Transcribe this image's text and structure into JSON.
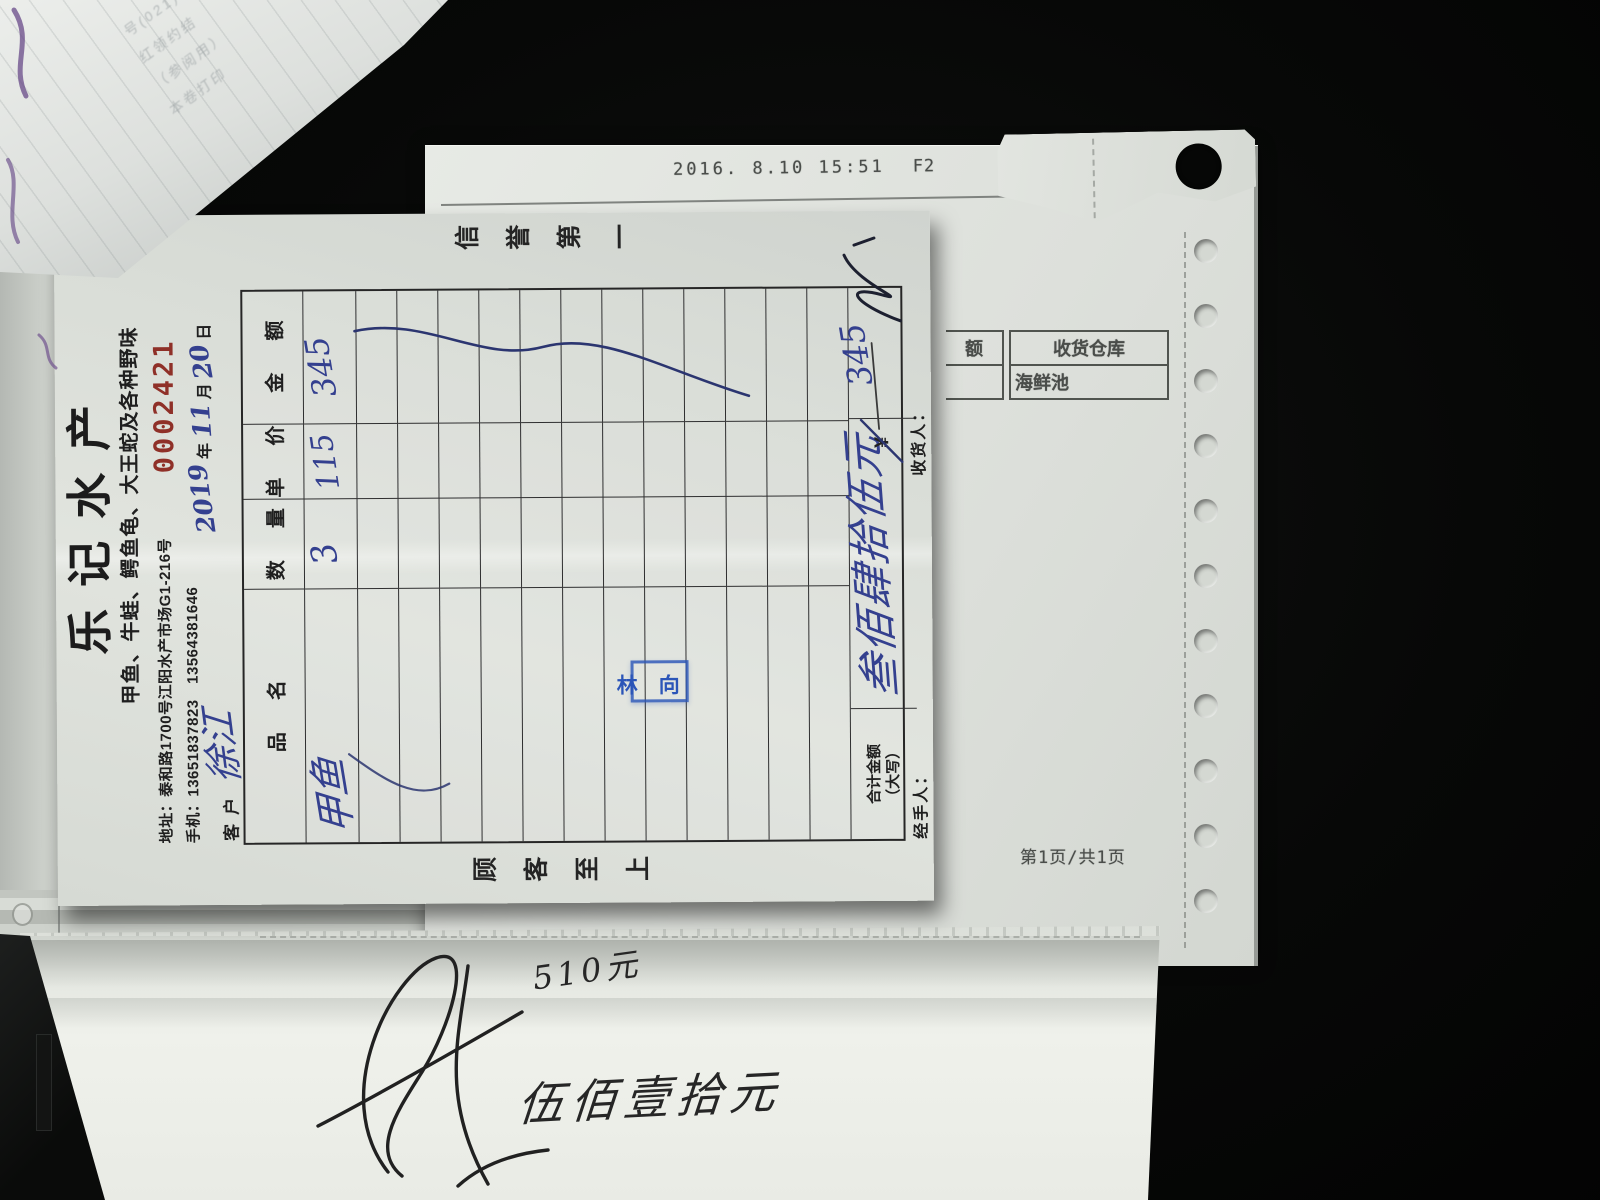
{
  "colors": {
    "ink_blue": "#34408f",
    "stamp_blue": "#2b55b8",
    "serial_red": "#8f3028",
    "paper": "#dfe2dc",
    "desk_black": "#070807"
  },
  "receipt": {
    "serial": "0002421",
    "title": "乐记水产",
    "subtitle": "甲鱼、牛蛙、鳄鱼龟、大王蛇及各种野味",
    "address_label": "地址：",
    "address": "泰和路1700号江阳水产市场G1-216号",
    "phone_label": "手机：",
    "phones": "13651837823　13564381646",
    "date": {
      "year": "2019",
      "year_label": "年",
      "month": "11",
      "month_label": "月",
      "day": "20",
      "day_label": "日"
    },
    "customer_label": "客户",
    "customer_name": "徐江",
    "slogan_left": "顾客至上",
    "slogan_right": "信誉第一",
    "table": {
      "headers": [
        "品名",
        "数量",
        "单价",
        "金额"
      ],
      "rows": [
        {
          "name": "甲鱼",
          "qty": "3",
          "price": "115",
          "amount": "345"
        }
      ],
      "total_label": "合计金额",
      "total_label2": "（大写）",
      "total_cn": "叁佰肆拾伍元",
      "currency": "¥",
      "total_amount": "345"
    },
    "signers": {
      "handler_label": "经手人：",
      "receiver_label": "收货人："
    },
    "stamp": {
      "left": "林",
      "right": "向"
    }
  },
  "back_sheet": {
    "timestamp": "2016. 8.10 15:51",
    "mode": "F2",
    "warehouse_table": {
      "col1": "额",
      "header": "收货仓库",
      "value": "海鲜池"
    },
    "page_footer": "第1页/共1页"
  },
  "bottom_sheet": {
    "amount_numeric": "510元",
    "amount_cn": "伍佰壹拾元"
  },
  "pad_fragments": {
    "l1": "号(021)13002256",
    "l2": "红领约结",
    "l3": "（参阅用）",
    "l4": "本卷打印"
  }
}
